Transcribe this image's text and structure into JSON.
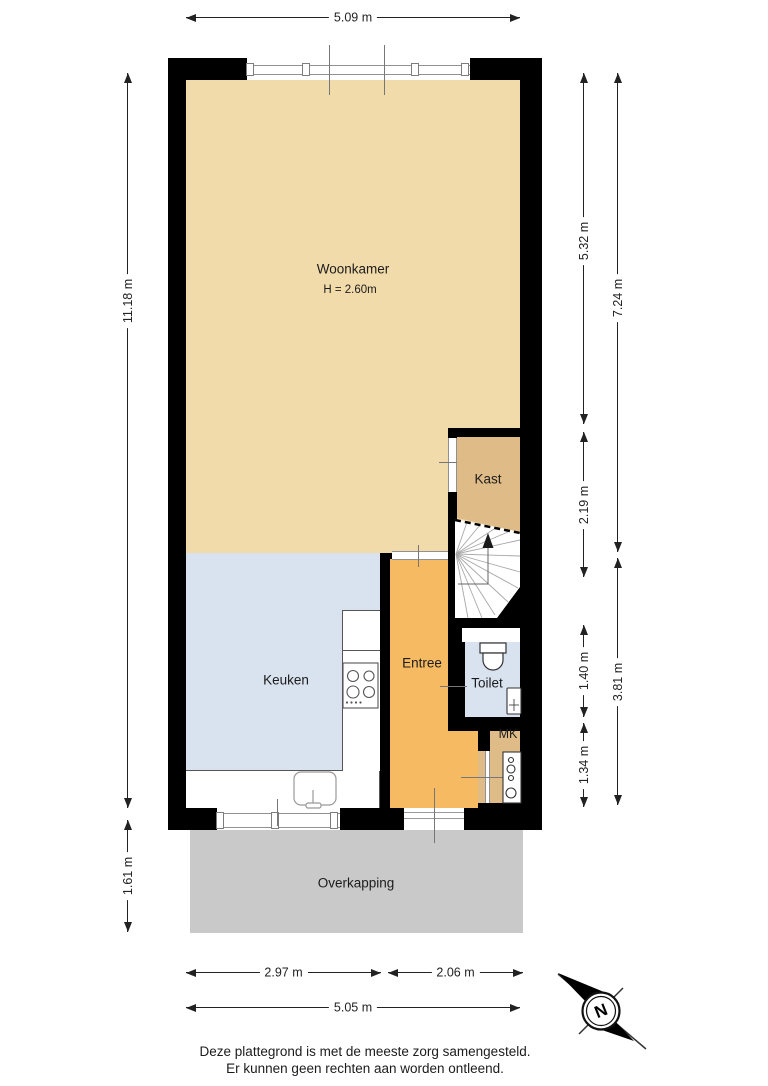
{
  "floorplan": {
    "rooms": {
      "woonkamer": {
        "label": "Woonkamer",
        "height_note": "H = 2.60m"
      },
      "kast": {
        "label": "Kast"
      },
      "keuken": {
        "label": "Keuken"
      },
      "entree": {
        "label": "Entree"
      },
      "toilet": {
        "label": "Toilet"
      },
      "mk": {
        "label": "MK"
      },
      "overkapping": {
        "label": "Overkapping"
      }
    },
    "dimensions": {
      "top_width": "5.09 m",
      "left_height": "11.18 m",
      "left_overkapping": "1.61 m",
      "right_inner_woonkamer": "5.32 m",
      "right_inner_kast": "2.19 m",
      "right_inner_toilet": "1.40 m",
      "right_inner_mk": "1.34 m",
      "right_outer_top": "7.24 m",
      "right_outer_bottom": "3.81 m",
      "bottom_keuken": "2.97 m",
      "bottom_entree": "2.06 m",
      "bottom_total": "5.05 m"
    },
    "compass": {
      "label": "N"
    },
    "disclaimer": {
      "line1": "Deze plattegrond is met de meeste zorg samengesteld.",
      "line2": "Er kunnen geen rechten aan worden ontleend."
    },
    "colors": {
      "woonkamer_floor": "#f2dbaa",
      "kast_floor": "#dfbc87",
      "keuken_floor": "#d9e2ef",
      "entree_floor": "#f6ba62",
      "toilet_floor": "#d9e2ef",
      "overkapping": "#c9c9c9",
      "walls": "#000000"
    }
  }
}
